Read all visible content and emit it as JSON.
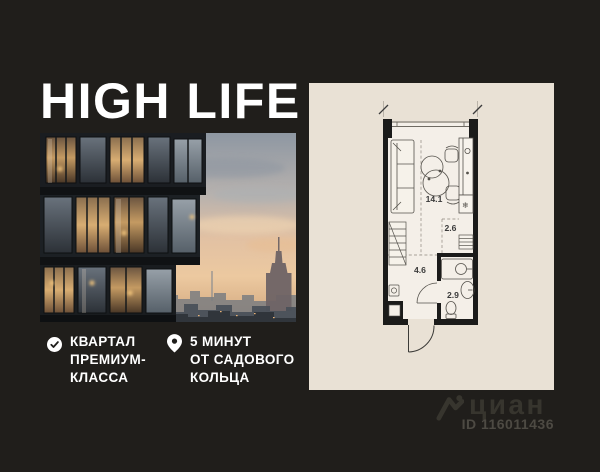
{
  "title": "HIGH LIFE",
  "features": [
    {
      "icon": "check-circle-icon",
      "lines": [
        "КВАРТАЛ",
        "ПРЕМИУМ-",
        "КЛАССА"
      ]
    },
    {
      "icon": "location-pin-icon",
      "lines": [
        "5 МИНУТ",
        "ОТ САДОВОГО",
        "КОЛЬЦА"
      ]
    }
  ],
  "floor_plan": {
    "rooms": [
      {
        "name": "living-kitchen",
        "area_label": "14.1"
      },
      {
        "name": "kitchen-passage",
        "area_label": "2.6"
      },
      {
        "name": "hallway",
        "area_label": "4.6"
      },
      {
        "name": "bathroom",
        "area_label": "2.9"
      }
    ],
    "fridge_glyph": "❄"
  },
  "watermark": {
    "brand": "циан",
    "id_label": "ID 116011436"
  },
  "colors": {
    "background": "#201e1b",
    "panel": "#e9e1d5",
    "plan_floor": "#f4efe8",
    "walls": "#1b1b1a",
    "text": "#ffffff",
    "watermark": "#37352e"
  }
}
